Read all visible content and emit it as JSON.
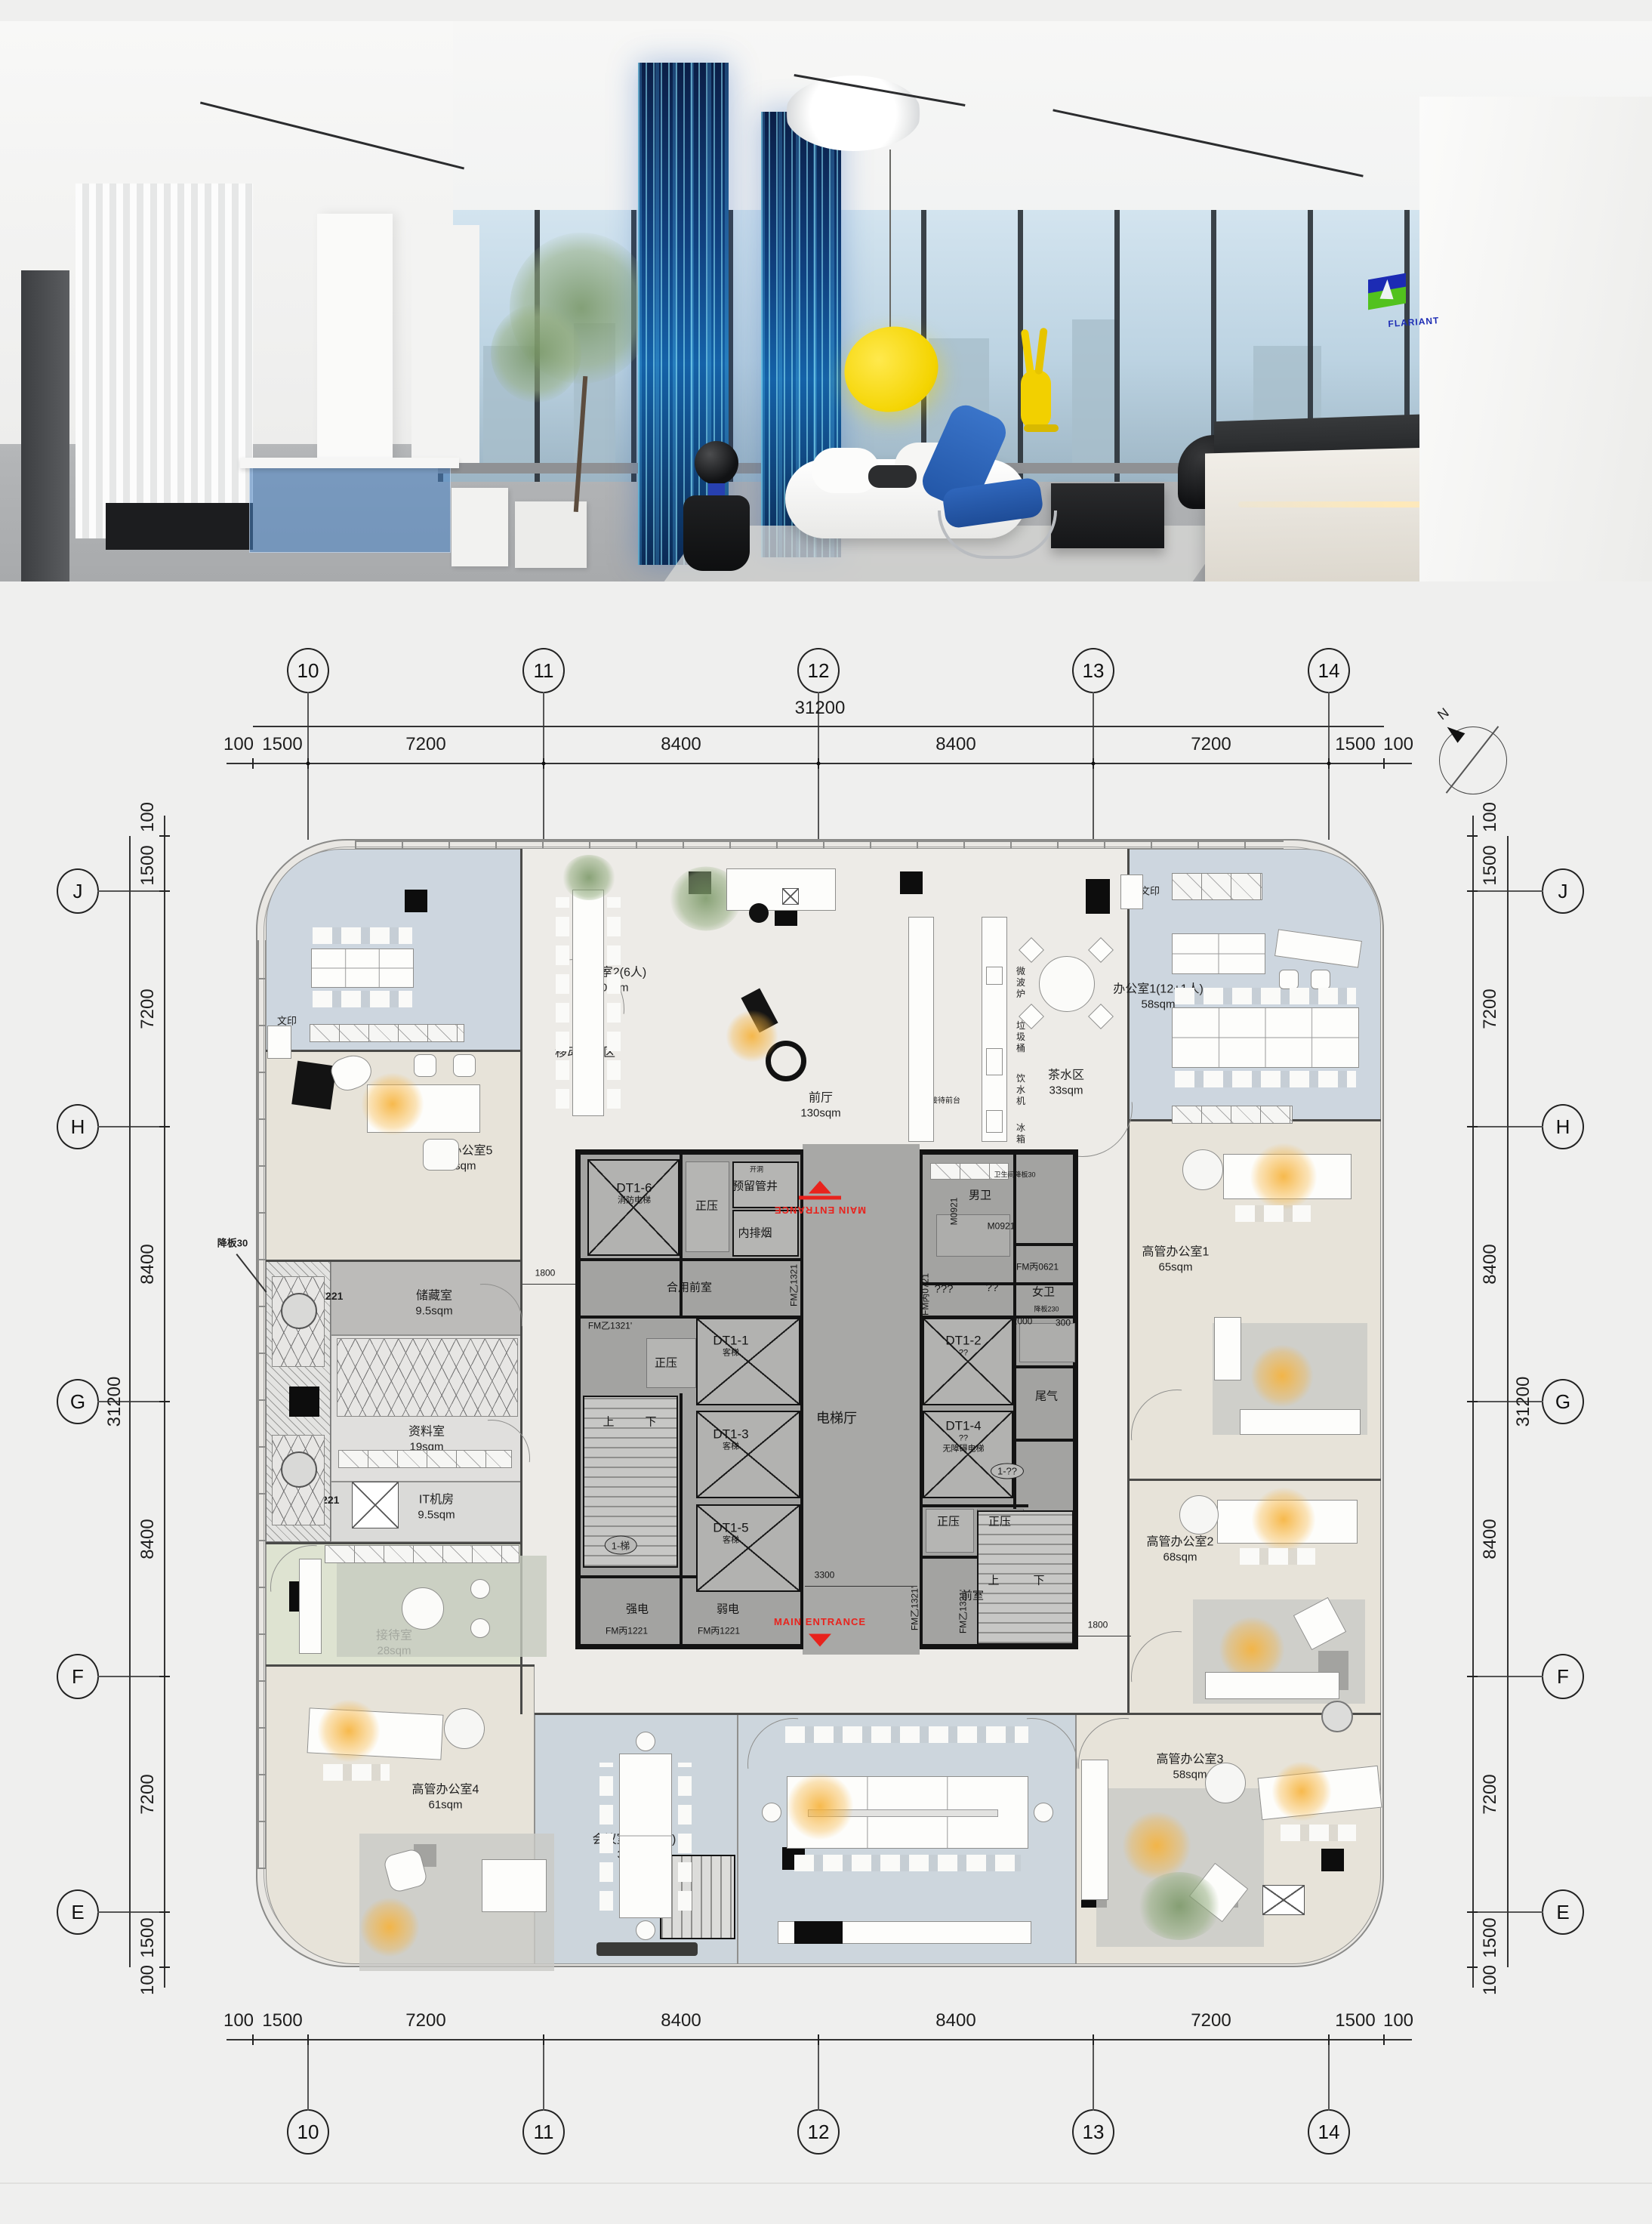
{
  "photo": {
    "wall_logo": "FLARIANT",
    "desk_logo": "FLARIANT"
  },
  "plan": {
    "north": "N",
    "grid": {
      "cols": [
        "10",
        "11",
        "12",
        "13",
        "14"
      ],
      "rows": [
        "J",
        "H",
        "G",
        "F",
        "E"
      ]
    },
    "dims": {
      "total": "31200",
      "segments": [
        "100",
        "1500",
        "7200",
        "8400",
        "8400",
        "7200",
        "1500",
        "100"
      ],
      "d1800": "1800",
      "d3300": "3300",
      "d2000": "2000",
      "d300": "300"
    },
    "rooms": {
      "office2": {
        "name": "办公室2(6人)",
        "area": "40sqm"
      },
      "mobile": {
        "name": "移动办公区"
      },
      "hall": {
        "name": "前厅",
        "area": "130sqm"
      },
      "hall_counter": "接待前台",
      "tea": {
        "name": "茶水区",
        "area": "33sqm"
      },
      "appliances": [
        "微波炉",
        "垃圾桶",
        "饮水机",
        "冰箱"
      ],
      "office1": {
        "name": "办公室1(12+1人)",
        "area": "58sqm"
      },
      "print": "文印",
      "exec1": {
        "name": "高管办公室1",
        "area": "65sqm"
      },
      "exec2": {
        "name": "高管办公室2",
        "area": "68sqm"
      },
      "exec3": {
        "name": "高管办公室3",
        "area": "58sqm"
      },
      "exec4": {
        "name": "高管办公室4",
        "area": "61sqm"
      },
      "exec5": {
        "name": "高管办公室5",
        "area": "46sqm"
      },
      "storage": {
        "name": "储藏室",
        "area": "9.5sqm"
      },
      "archive": {
        "name": "资料室",
        "area": "19sqm"
      },
      "it": {
        "name": "IT机房",
        "area": "9.5sqm"
      },
      "platform": "设备平台",
      "reception": {
        "name": "接待室",
        "area": "28sqm"
      },
      "meeting": {
        "name": "会议室(12+6人)",
        "area": "35sqm"
      },
      "bigmeeting": {
        "name": "大会议室（20+20人）",
        "area": "79sqm"
      }
    },
    "core": {
      "hall": "电梯厅",
      "dt11": "DT1-1",
      "dt12": "DT1-2",
      "dt13": "DT1-3",
      "dt14": "DT1-4",
      "dt15": "DT1-5",
      "dt16": "DT1-6",
      "passenger": "客梯",
      "fire_lift": "消防电梯",
      "barrier_free": "无障碍电梯",
      "unknown2": "??",
      "unknown3": "???",
      "shared_lobby": "合用前室",
      "front_room": "前室",
      "positive_pressure": "正压",
      "reserved_shaft": "预留管井",
      "opening": "开洞",
      "smoke_exhaust": "内排烟",
      "exhaust": "尾气",
      "male_wc": "男卫",
      "female_wc": "女卫",
      "strong_power": "强电",
      "weak_power": "弱电",
      "up": "上",
      "down": "下",
      "stair1": "1-梯",
      "stair2": "1-??",
      "main_entrance": "MAIN ENTRANCE",
      "doors": {
        "fm1321": "FM乙1321",
        "fm1321b": "FM乙1321'",
        "fm1221": "FM丙1221",
        "fm0721": "FM丙0721",
        "fm0621": "FM丙0621",
        "m0921": "M0921",
        "m1221": "M1221"
      }
    },
    "annotations": {
      "drop30": "降板30",
      "wc_drop30": "卫生间降板30",
      "drop230": "降板230"
    }
  }
}
